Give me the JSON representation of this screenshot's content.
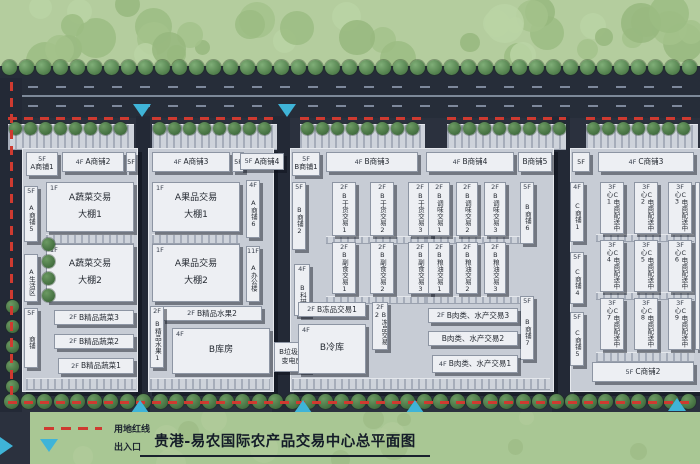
{
  "title": "贵港-易农国际农产品交易中心总平面图",
  "legend": {
    "red_line": "用地红线",
    "entrance": "出入口"
  },
  "colors": {
    "red_line": "#cf3a30",
    "entrance_marker": "#3fb4d8",
    "field_green": "#b4cd9e",
    "tree_green": "#4e7c49",
    "road_dark": "#262d39",
    "platform_gray": "#c7ccd5",
    "building_white": "#edeff3"
  },
  "blocks": [
    {
      "name": "block-a1",
      "x": 22,
      "y": 148,
      "w": 114,
      "h": 242
    },
    {
      "name": "block-a2",
      "x": 148,
      "y": 148,
      "w": 124,
      "h": 242
    },
    {
      "name": "block-b",
      "x": 290,
      "y": 148,
      "w": 262,
      "h": 242
    },
    {
      "name": "block-c",
      "x": 570,
      "y": 148,
      "w": 132,
      "h": 242
    }
  ],
  "buildings": [
    {
      "l": "A商铺1",
      "f": "5F",
      "k": "bx",
      "x": 26,
      "y": 152,
      "w": 32,
      "h": 24
    },
    {
      "l": "A商铺2",
      "f": "4F",
      "k": "h",
      "x": 62,
      "y": 152,
      "w": 62,
      "h": 20
    },
    {
      "l": "5F",
      "k": "tag",
      "x": 126,
      "y": 152,
      "w": 10,
      "h": 20
    },
    {
      "l": "A商铺5",
      "f": "5F",
      "k": "v",
      "x": 24,
      "y": 186,
      "w": 14,
      "h": 56
    },
    {
      "l": "A生活区",
      "k": "v",
      "x": 24,
      "y": 254,
      "w": 14,
      "h": 48
    },
    {
      "l": "商铺",
      "f": "5F",
      "k": "v",
      "x": 24,
      "y": 308,
      "w": 14,
      "h": 60
    },
    {
      "l": "A蔬菜交易",
      "s": "大棚1",
      "f": "1F",
      "k": "s",
      "x": 46,
      "y": 182,
      "w": 88,
      "h": 50
    },
    {
      "l": "A蔬菜交易",
      "s": "大棚2",
      "f": "1F",
      "k": "s",
      "x": 46,
      "y": 244,
      "w": 88,
      "h": 58
    },
    {
      "l": "B精品蔬菜3",
      "f": "2F",
      "k": "h",
      "x": 54,
      "y": 310,
      "w": 80,
      "h": 15
    },
    {
      "l": "B精品蔬菜2",
      "f": "2F",
      "k": "h",
      "x": 54,
      "y": 334,
      "w": 80,
      "h": 15
    },
    {
      "l": "B精品蔬菜1",
      "f": "2F",
      "k": "h",
      "x": 58,
      "y": 358,
      "w": 76,
      "h": 16
    },
    {
      "l": "A商铺3",
      "f": "4F",
      "k": "h",
      "x": 152,
      "y": 152,
      "w": 78,
      "h": 20
    },
    {
      "l": "5F",
      "k": "tag",
      "x": 232,
      "y": 152,
      "w": 12,
      "h": 20
    },
    {
      "l": "A商铺4",
      "f": "5F",
      "k": "h",
      "x": 240,
      "y": 153,
      "w": 44,
      "h": 17
    },
    {
      "l": "A果品交易",
      "s": "大棚1",
      "f": "1F",
      "k": "s",
      "x": 152,
      "y": 182,
      "w": 88,
      "h": 50
    },
    {
      "l": "A果品交易",
      "s": "大棚2",
      "f": "1F",
      "k": "s",
      "x": 152,
      "y": 244,
      "w": 88,
      "h": 58
    },
    {
      "l": "A商铺6",
      "f": "4F",
      "k": "v",
      "x": 246,
      "y": 180,
      "w": 14,
      "h": 58
    },
    {
      "l": "A办公楼",
      "f": "11F",
      "k": "v",
      "x": 246,
      "y": 246,
      "w": 14,
      "h": 56
    },
    {
      "l": "B精品水果2",
      "f": "2F",
      "k": "h",
      "x": 162,
      "y": 306,
      "w": 100,
      "h": 15
    },
    {
      "l": "B精品水果1",
      "f": "2F",
      "k": "v",
      "x": 150,
      "y": 306,
      "w": 14,
      "h": 62
    },
    {
      "l": "B库房",
      "f": "4F",
      "k": "b",
      "x": 172,
      "y": 328,
      "w": 98,
      "h": 46
    },
    {
      "l": "B垃圾房",
      "s": "变电房",
      "k": "bx2",
      "x": 274,
      "y": 342,
      "w": 36,
      "h": 30
    },
    {
      "l": "B商铺1",
      "f": "5F",
      "k": "bx",
      "x": 292,
      "y": 152,
      "w": 28,
      "h": 24
    },
    {
      "l": "B商铺3",
      "f": "4F",
      "k": "h",
      "x": 326,
      "y": 152,
      "w": 92,
      "h": 20
    },
    {
      "l": "B商铺2",
      "f": "5F",
      "k": "v",
      "x": 292,
      "y": 182,
      "w": 14,
      "h": 68
    },
    {
      "l": "B科研",
      "f": "4F",
      "k": "v",
      "x": 294,
      "y": 264,
      "w": 16,
      "h": 52
    },
    {
      "l": "B干货交易1",
      "f": "2F",
      "k": "v",
      "x": 332,
      "y": 182,
      "w": 24,
      "h": 54
    },
    {
      "l": "B干货交易2",
      "f": "2F",
      "k": "v",
      "x": 370,
      "y": 182,
      "w": 24,
      "h": 54
    },
    {
      "l": "B干货交易3",
      "f": "2F",
      "k": "v",
      "x": 408,
      "y": 182,
      "w": 24,
      "h": 54
    },
    {
      "l": "B副食交易1",
      "f": "2F",
      "k": "v",
      "x": 332,
      "y": 242,
      "w": 24,
      "h": 52
    },
    {
      "l": "B副食交易2",
      "f": "2F",
      "k": "v",
      "x": 370,
      "y": 242,
      "w": 24,
      "h": 52
    },
    {
      "l": "B副食交易3",
      "f": "2F",
      "k": "v",
      "x": 408,
      "y": 242,
      "w": 24,
      "h": 52
    },
    {
      "l": "B商铺4",
      "f": "4F",
      "k": "h",
      "x": 426,
      "y": 152,
      "w": 88,
      "h": 20
    },
    {
      "l": "B商铺5",
      "k": "h",
      "x": 518,
      "y": 152,
      "w": 34,
      "h": 20
    },
    {
      "l": "B调味交易1",
      "f": "2F",
      "k": "v",
      "x": 428,
      "y": 182,
      "w": 22,
      "h": 54
    },
    {
      "l": "B调味交易2",
      "f": "2F",
      "k": "v",
      "x": 456,
      "y": 182,
      "w": 22,
      "h": 54
    },
    {
      "l": "B调味交易3",
      "f": "2F",
      "k": "v",
      "x": 484,
      "y": 182,
      "w": 22,
      "h": 54
    },
    {
      "l": "B粮油交易1",
      "f": "2F",
      "k": "v",
      "x": 428,
      "y": 242,
      "w": 22,
      "h": 52
    },
    {
      "l": "B粮油交易2",
      "f": "2F",
      "k": "v",
      "x": 456,
      "y": 242,
      "w": 22,
      "h": 52
    },
    {
      "l": "B粮油交易3",
      "f": "2F",
      "k": "v",
      "x": 484,
      "y": 242,
      "w": 22,
      "h": 52
    },
    {
      "l": "B商铺6",
      "f": "5F",
      "k": "v",
      "x": 520,
      "y": 182,
      "w": 14,
      "h": 62
    },
    {
      "l": "B商铺7",
      "f": "5F",
      "k": "v",
      "x": 520,
      "y": 296,
      "w": 14,
      "h": 64
    },
    {
      "l": "B冻品交易1",
      "f": "2F",
      "k": "h",
      "x": 298,
      "y": 302,
      "w": 68,
      "h": 15
    },
    {
      "l": "B冻品交易2",
      "f": "2F",
      "k": "v",
      "x": 372,
      "y": 302,
      "w": 16,
      "h": 48
    },
    {
      "l": "B冷库",
      "f": "4F",
      "k": "b",
      "x": 298,
      "y": 324,
      "w": 68,
      "h": 50
    },
    {
      "l": "B肉类、水产交易3",
      "f": "2F",
      "k": "h",
      "x": 428,
      "y": 308,
      "w": 90,
      "h": 15
    },
    {
      "l": "B肉类、水产交易2",
      "k": "h",
      "x": 428,
      "y": 331,
      "w": 90,
      "h": 15
    },
    {
      "l": "B肉类、水产交易1",
      "f": "4F",
      "k": "h",
      "x": 432,
      "y": 355,
      "w": 86,
      "h": 18
    },
    {
      "l": "5F",
      "k": "tag",
      "x": 572,
      "y": 152,
      "w": 18,
      "h": 20
    },
    {
      "l": "C商铺3",
      "f": "4F",
      "k": "h",
      "x": 598,
      "y": 152,
      "w": 96,
      "h": 20
    },
    {
      "l": "C商铺1",
      "f": "4F",
      "k": "v",
      "x": 570,
      "y": 182,
      "w": 14,
      "h": 60
    },
    {
      "l": "C商铺4",
      "f": "5F",
      "k": "v",
      "x": 570,
      "y": 252,
      "w": 14,
      "h": 52
    },
    {
      "l": "C商铺5",
      "f": "5F",
      "k": "v",
      "x": 570,
      "y": 312,
      "w": 14,
      "h": 54
    },
    {
      "l": "C商铺2",
      "f": "5F",
      "k": "h",
      "x": 592,
      "y": 362,
      "w": 102,
      "h": 20
    },
    {
      "l": "C电商配送中心1",
      "f": "3F",
      "k": "v",
      "x": 600,
      "y": 182,
      "w": 24,
      "h": 52
    },
    {
      "l": "C电商配送中心2",
      "f": "3F",
      "k": "v",
      "x": 634,
      "y": 182,
      "w": 24,
      "h": 52
    },
    {
      "l": "C电商配送中心3",
      "f": "3F",
      "k": "v",
      "x": 668,
      "y": 182,
      "w": 24,
      "h": 52
    },
    {
      "l": "C电商配送中心4",
      "f": "3F",
      "k": "v",
      "x": 600,
      "y": 240,
      "w": 24,
      "h": 52
    },
    {
      "l": "C电商配送中心5",
      "f": "3F",
      "k": "v",
      "x": 634,
      "y": 240,
      "w": 24,
      "h": 52
    },
    {
      "l": "C电商配送中心6",
      "f": "3F",
      "k": "v",
      "x": 668,
      "y": 240,
      "w": 24,
      "h": 52
    },
    {
      "l": "C电商配送中心7",
      "f": "3F",
      "k": "v",
      "x": 600,
      "y": 298,
      "w": 24,
      "h": 52
    },
    {
      "l": "C电商配送中心8",
      "f": "3F",
      "k": "v",
      "x": 634,
      "y": 298,
      "w": 24,
      "h": 52
    },
    {
      "l": "C电商配送中心9",
      "f": "3F",
      "k": "v",
      "x": 668,
      "y": 298,
      "w": 24,
      "h": 52
    }
  ]
}
